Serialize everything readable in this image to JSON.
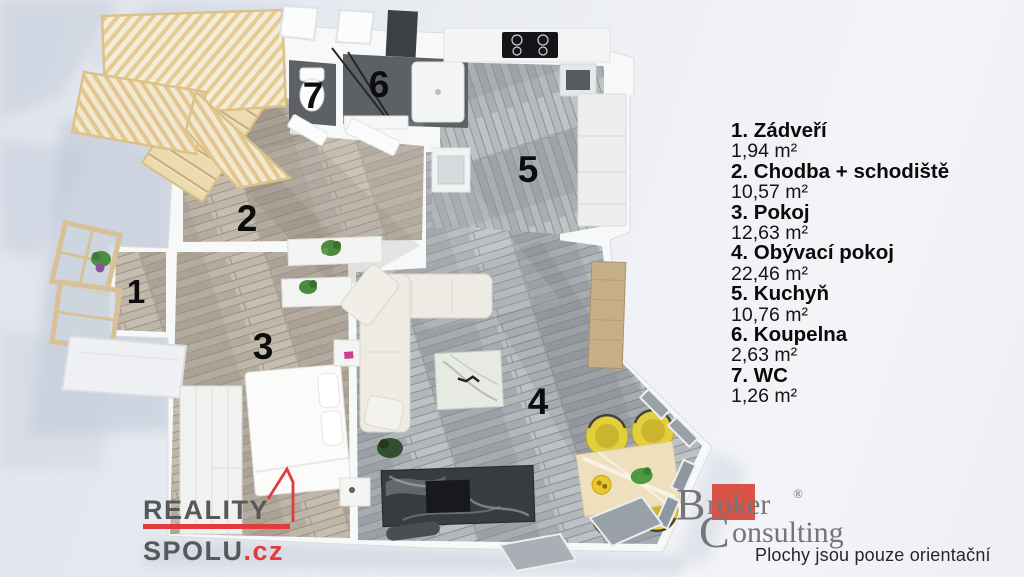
{
  "page": {
    "type": "3d-floor-plan-render"
  },
  "rooms": [
    {
      "number": "1",
      "label": "1. Zádveří",
      "area": "1,94 m²"
    },
    {
      "number": "2",
      "label": "2. Chodba + schodiště",
      "area": "10,57 m²"
    },
    {
      "number": "3",
      "label": "3. Pokoj",
      "area": "12,63 m²"
    },
    {
      "number": "4",
      "label": "4. Obývací pokoj",
      "area": "22,46 m²"
    },
    {
      "number": "5",
      "label": "5. Kuchyň",
      "area": "10,76 m²"
    },
    {
      "number": "6",
      "label": "6. Koupelna",
      "area": "2,63 m²"
    },
    {
      "number": "7",
      "label": "7. WC",
      "area": "1,26 m²"
    }
  ],
  "branding": {
    "reality_spolu": {
      "word1": "REALITY",
      "word2": "SPOLU",
      "tld": ".cz"
    },
    "broker_consulting": {
      "initial1": "B",
      "rest1": "roker",
      "registered": "®",
      "initial2": "C",
      "rest2": "onsulting"
    },
    "disclaimer": "Plochy jsou pouze orientační"
  },
  "colors": {
    "reality_red": "#e23b3c",
    "reality_gray": "#57585c",
    "broker_red": "#d84a3c",
    "broker_gray": "#74747a",
    "legend_text": "#0a0a0a",
    "floor_wood": "#b4aba0",
    "floor_gray": "#a6abaf",
    "floor_dark": "#5d6166",
    "stair_wood": "#e9d3a0",
    "chair_yellow": "#e3cf3b",
    "plant_green": "#4b8a3f",
    "wall_white": "#f7f8f8"
  }
}
